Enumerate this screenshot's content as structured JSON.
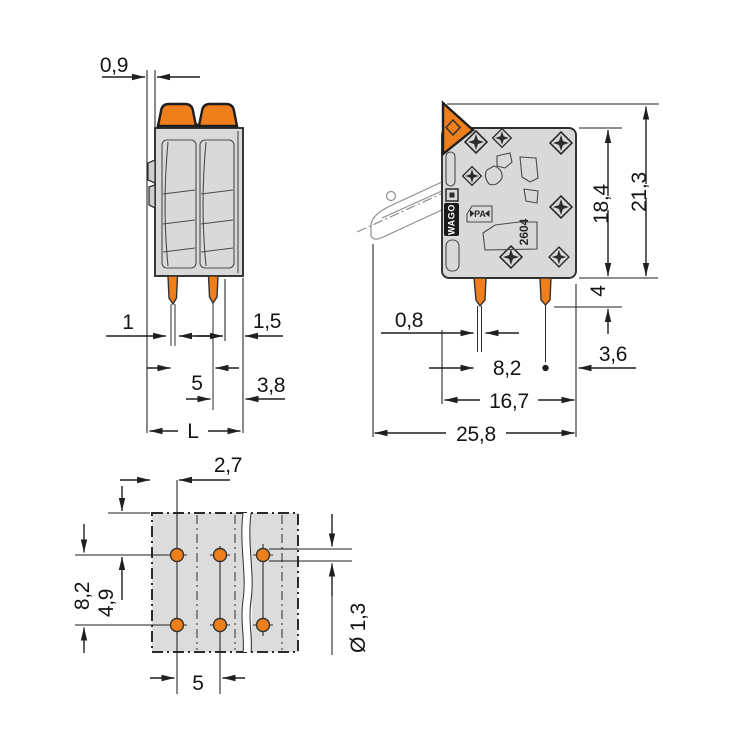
{
  "drawing_title": "PCB terminal block dimensional drawing",
  "views": {
    "front": {
      "name": "front-view",
      "dims": {
        "latch_offset": "0,9",
        "pin_width": "1",
        "right_wall": "1,5",
        "pin_pitch": "5",
        "pin_to_edge": "3,8",
        "total_length": "L"
      }
    },
    "side": {
      "name": "side-view",
      "dims": {
        "body_height": "18,4",
        "total_height": "21,3",
        "pin_length": "4",
        "pin_thickness": "0,8",
        "pin_row_spacing": "8,2",
        "pin_to_edge": "3,6",
        "body_depth": "16,7",
        "total_depth": "25,8"
      },
      "markings": {
        "brand": "WAGO",
        "material": "PA",
        "series": "2604"
      }
    },
    "footprint": {
      "name": "drilling-plan",
      "dims": {
        "edge_to_first_column": "2,7",
        "row_spacing": "8,2",
        "edge_to_first_row": "4,9",
        "column_pitch": "5",
        "hole_diameter": "Ø 1,3"
      }
    }
  },
  "colors": {
    "accent_orange": "#EE7F1B",
    "body_gray": "#D9D9D9",
    "footprint_gray": "#DCDCDC",
    "line_dark": "#1F1F1F",
    "ghost_gray": "#8E8E8E"
  }
}
